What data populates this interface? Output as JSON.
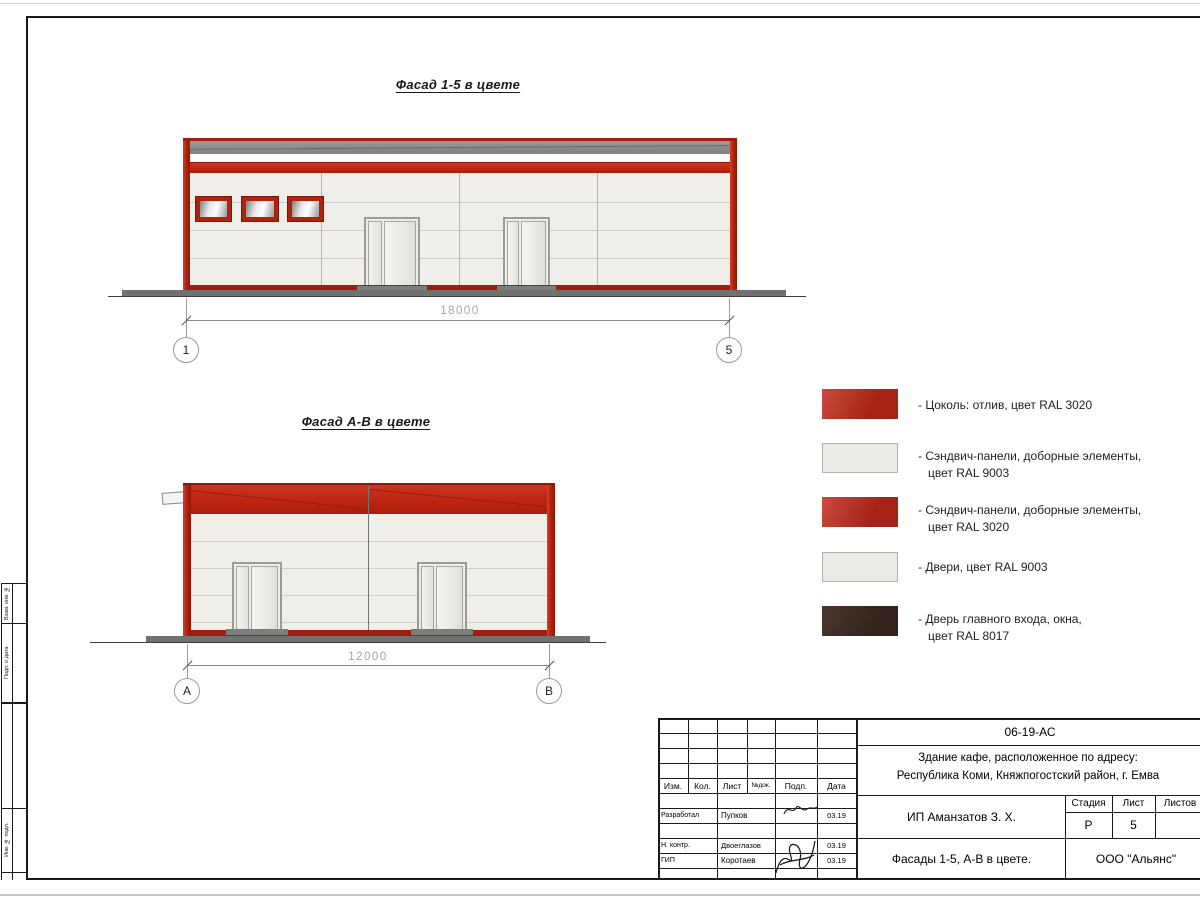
{
  "colors": {
    "ral3020_red": "#c1281a",
    "ral9003_light": "#ebebe6",
    "ral8017_brown": "#3d2b26",
    "roof_gray": "#8f8f8f",
    "ground_gray": "#717171"
  },
  "facades": {
    "f15": {
      "title": "Фасад 1-5 в цвете",
      "dimension": "18000",
      "axis_left": "1",
      "axis_right": "5"
    },
    "fab": {
      "title": "Фасад А-В в цвете",
      "dimension": "12000",
      "axis_left": "А",
      "axis_right": "В"
    }
  },
  "legend": {
    "items": [
      {
        "swatch": "red",
        "label": "- Цоколь: отлив, цвет RAL 3020",
        "line2": ""
      },
      {
        "swatch": "light",
        "label": "- Сэндвич-панели, доборные элементы,",
        "line2": "цвет RAL 9003"
      },
      {
        "swatch": "red",
        "label": "- Сэндвич-панели, доборные элементы,",
        "line2": "цвет RAL 3020"
      },
      {
        "swatch": "light",
        "label": "- Двери, цвет RAL 9003",
        "line2": ""
      },
      {
        "swatch": "dark",
        "label": "- Дверь главного входа, окна,",
        "line2": "цвет RAL 8017"
      }
    ]
  },
  "title_block": {
    "doc_number": "06-19-АС",
    "project_line1": "Здание кафе, расположенное по адресу:",
    "project_line2": "Республика Коми, Княжпогостский район, г. Емва",
    "client": "ИП Аманзатов З. Х.",
    "sheet_title": "Фасады 1-5, А-В в цвете.",
    "company": "ООО \"Альянс\"",
    "stage_label": "Стадия",
    "sheet_label": "Лист",
    "sheets_label": "Листов",
    "stage_value": "Р",
    "sheet_value": "5",
    "columns": [
      "Изм.",
      "Кол.",
      "Лист",
      "№док.",
      "Подп.",
      "Дата"
    ],
    "rows": [
      {
        "role": "Разработал",
        "name": "Пупков",
        "date": "03.19"
      },
      {
        "role": "Н. контр.",
        "name": "Двоеглазов",
        "date": "03.19"
      },
      {
        "role": "ГИП",
        "name": "Коротаев",
        "date": "03.19"
      }
    ]
  },
  "margin": {
    "labels": [
      "Взам. инв. №",
      "Подп. и дата",
      "Инв. № подл."
    ]
  }
}
